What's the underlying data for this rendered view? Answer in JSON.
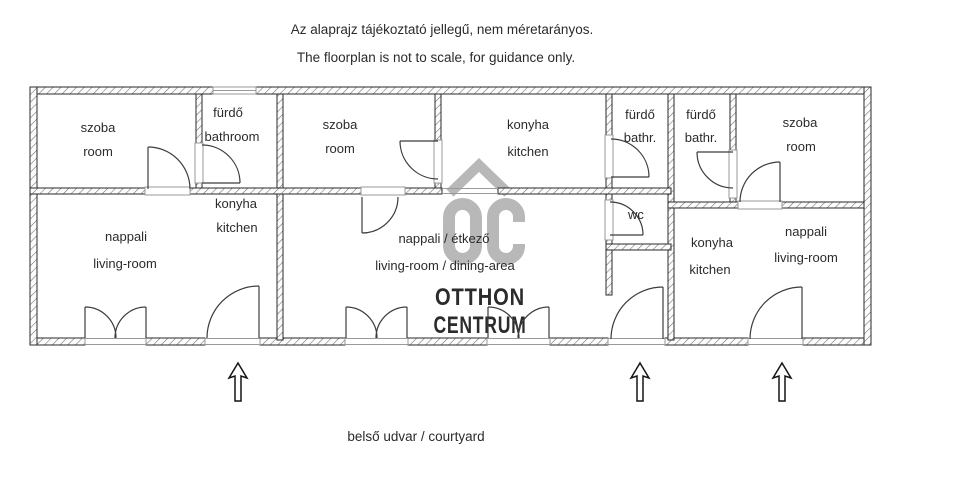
{
  "header": {
    "disclaimer_hu": "Az alaprajz tájékoztató jellegű, nem  méretarányos.",
    "disclaimer_en": "The floorplan is not to scale, for guidance only."
  },
  "footer": {
    "courtyard": "belső udvar / courtyard"
  },
  "watermark": {
    "logo_letters": "OC",
    "brand_line1": "OTTHON",
    "brand_line2": "CENTRUM"
  },
  "colors": {
    "wall_line": "#2a2a2a",
    "hatch": "#6b6b6b",
    "watermark": "#b8b8b8",
    "sill": "#999999",
    "text": "#2b2b2b"
  },
  "rooms": {
    "unit1_bedroom": {
      "hu": "szoba",
      "en": "room"
    },
    "unit1_bathroom": {
      "hu": "fürdő",
      "en": "bathroom"
    },
    "unit1_kitchen": {
      "hu": "konyha",
      "en": "kitchen"
    },
    "unit1_living": {
      "hu": "nappali",
      "en": "living-room"
    },
    "unit2_bedroom": {
      "hu": "szoba",
      "en": "room"
    },
    "unit2_kitchen": {
      "hu": "konyha",
      "en": "kitchen"
    },
    "unit2_living": {
      "hu": "nappali / étkező",
      "en": "living-room / dining-area"
    },
    "unit2_bathroom": {
      "hu": "fürdő",
      "en": "bathr."
    },
    "unit2_wc": {
      "hu": "wc"
    },
    "unit3_bathroom": {
      "hu": "fürdő",
      "en": "bathr."
    },
    "unit3_bedroom": {
      "hu": "szoba",
      "en": "room"
    },
    "unit3_kitchen": {
      "hu": "konyha",
      "en": "kitchen"
    },
    "unit3_living": {
      "hu": "nappali",
      "en": "living-room"
    }
  }
}
